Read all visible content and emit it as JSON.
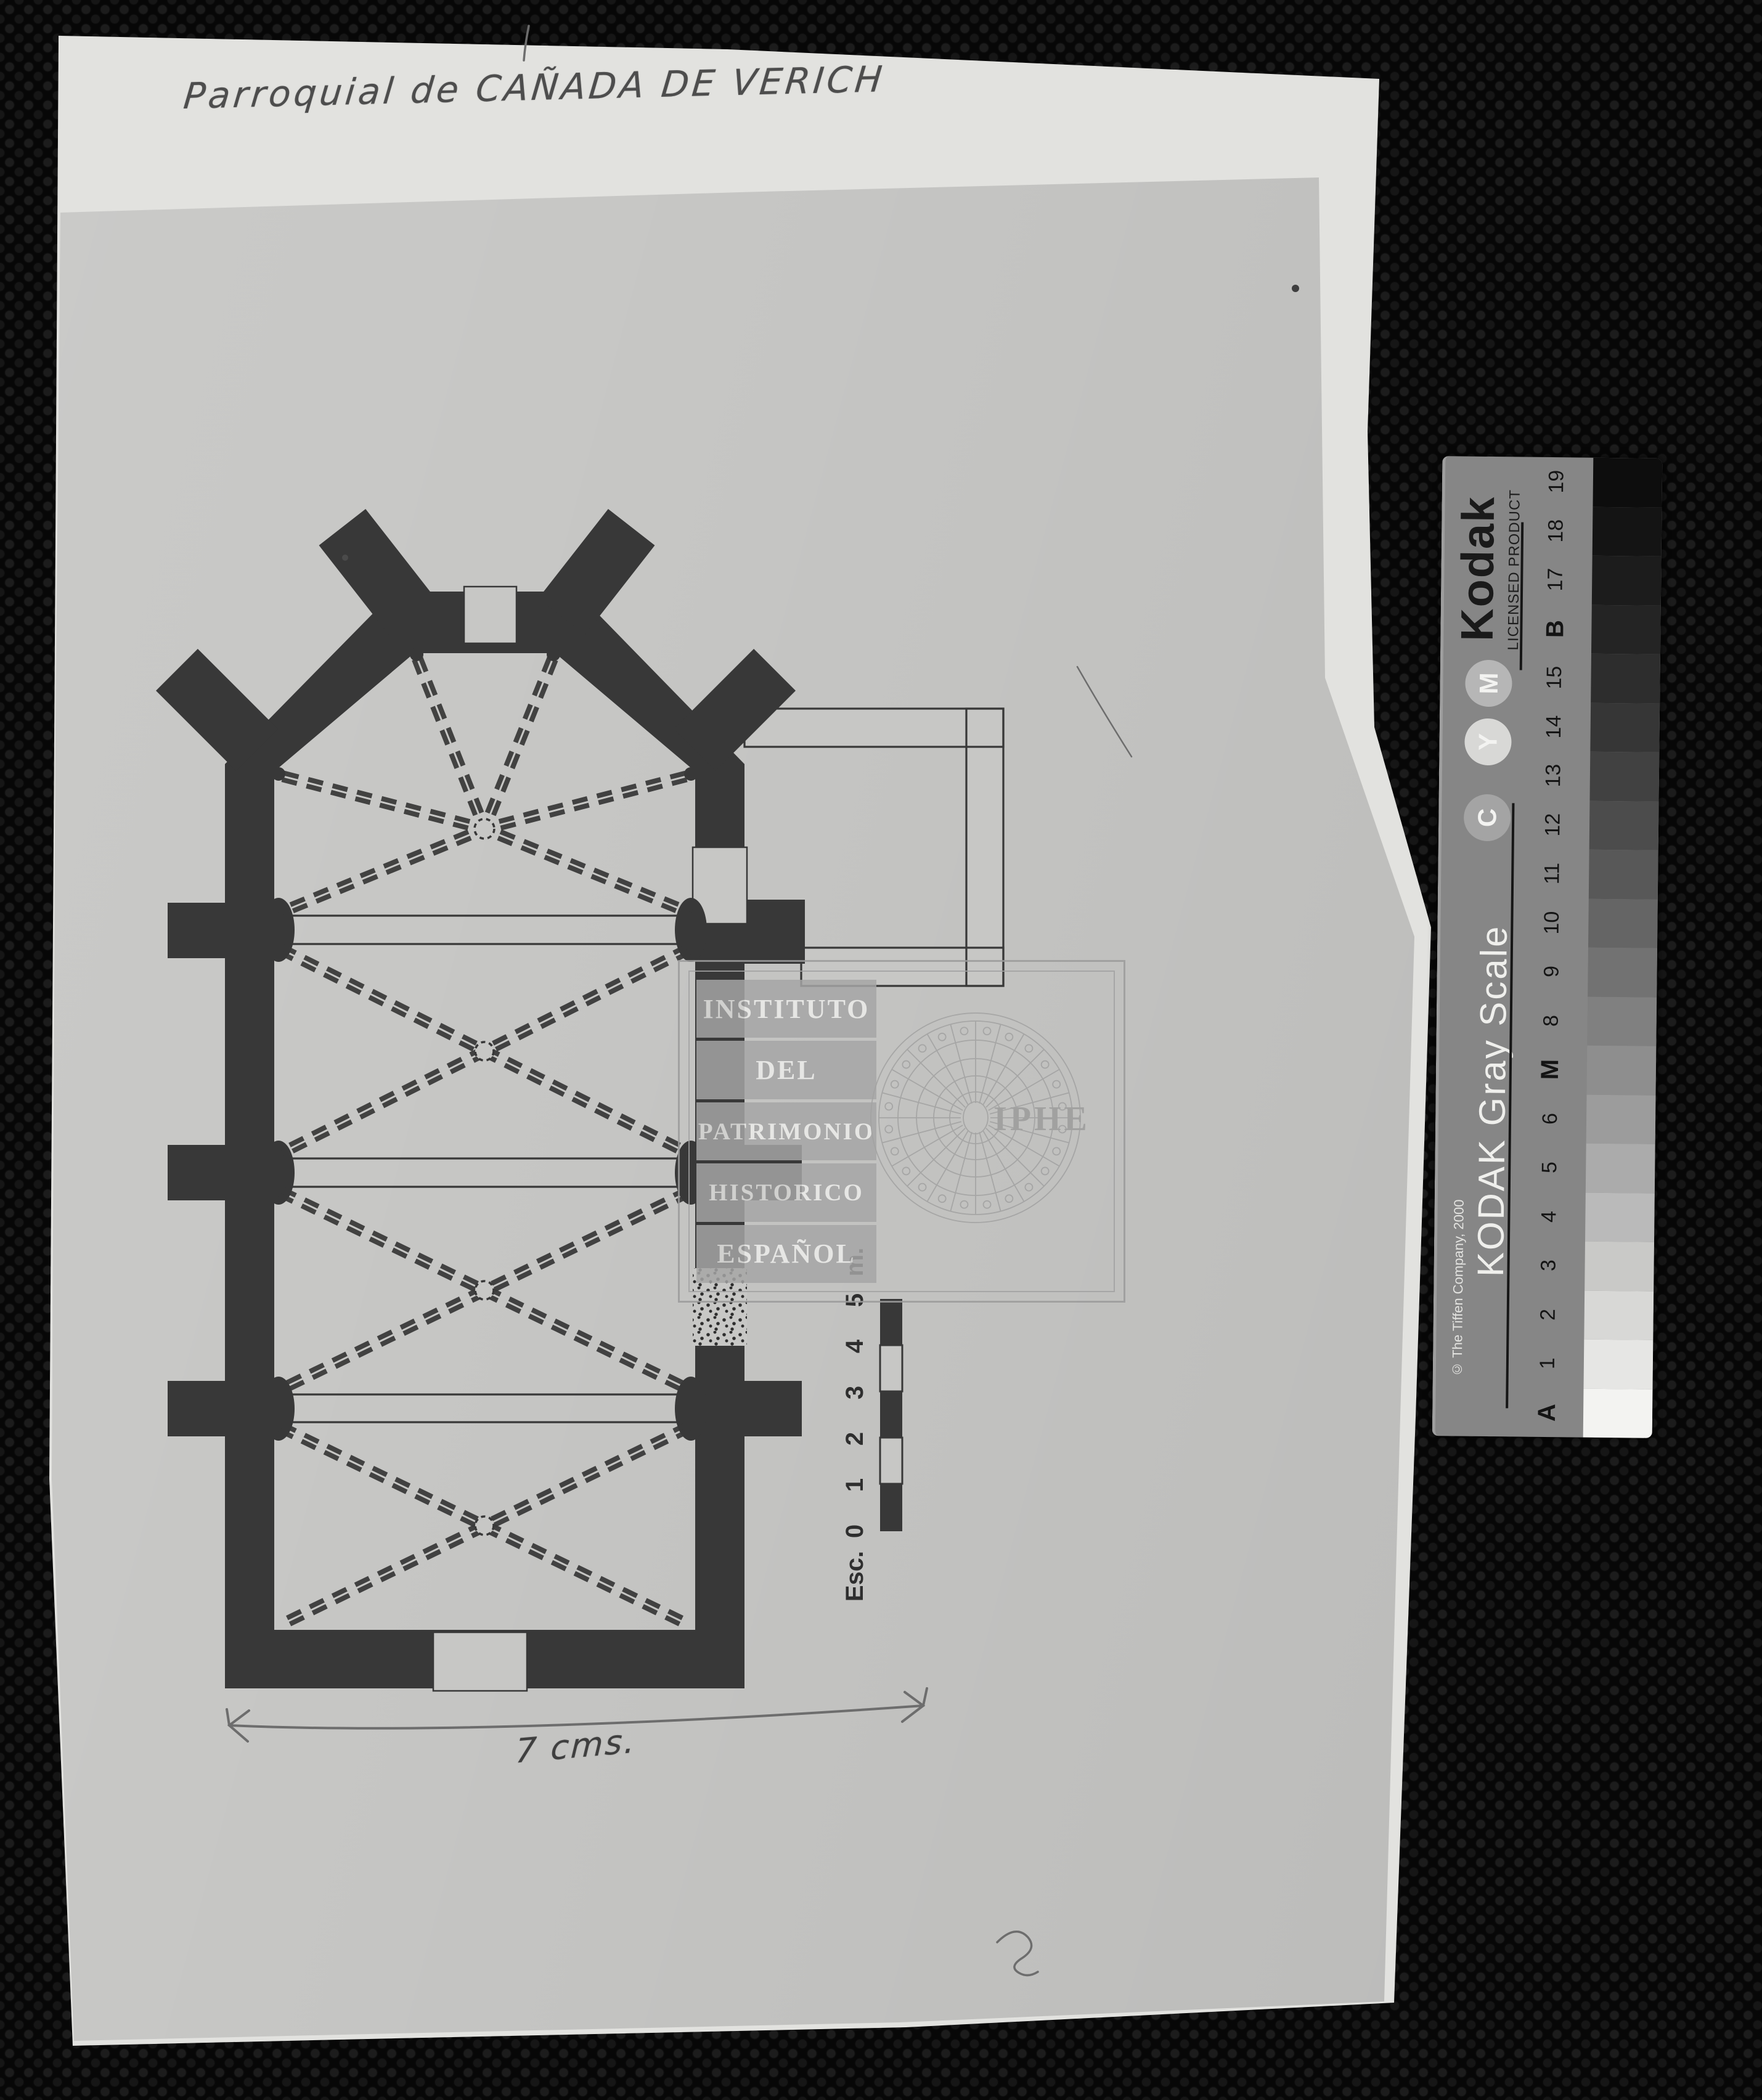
{
  "document": {
    "handwritten_title": "Parroquial de CAÑADA DE VERICH",
    "bottom_annotation": "7 cms.",
    "scale": {
      "prefix": "Esc.",
      "ticks": [
        "0",
        "1",
        "2",
        "3",
        "4",
        "5"
      ],
      "unit": "m."
    }
  },
  "stamp": {
    "lines": [
      "INSTITUTO",
      "DEL",
      "PATRIMONIO",
      "HISTORICO",
      "ESPAÑOL"
    ],
    "acronym": "IPHE"
  },
  "gray_scale": {
    "brand": "Kodak",
    "licensed": "LICENSED PRODUCT",
    "title": "KODAK Gray Scale",
    "copyright": "© The Tiffen Company, 2000",
    "cmy": [
      "C",
      "Y",
      "M"
    ],
    "labels": [
      "A",
      "1",
      "2",
      "3",
      "4",
      "5",
      "6",
      "M",
      "8",
      "9",
      "10",
      "11",
      "12",
      "13",
      "14",
      "15",
      "B",
      "17",
      "18",
      "19"
    ],
    "patch_colors": [
      "#f3f3f1",
      "#e6e6e4",
      "#d8d8d6",
      "#c9c9c7",
      "#bababa",
      "#ababab",
      "#9c9c9c",
      "#8e8e8e",
      "#808080",
      "#727272",
      "#656565",
      "#585858",
      "#4c4c4c",
      "#414141",
      "#363636",
      "#2d2d2d",
      "#242424",
      "#1c1c1c",
      "#141414",
      "#0d0d0d"
    ]
  },
  "colors": {
    "ink": "#383838",
    "paper": "#c7c7c5",
    "backing": "#e2e2df",
    "pencil": "#4d4d4d",
    "stamp_gray": "#a6a6a6",
    "strip_body": "#868686"
  }
}
